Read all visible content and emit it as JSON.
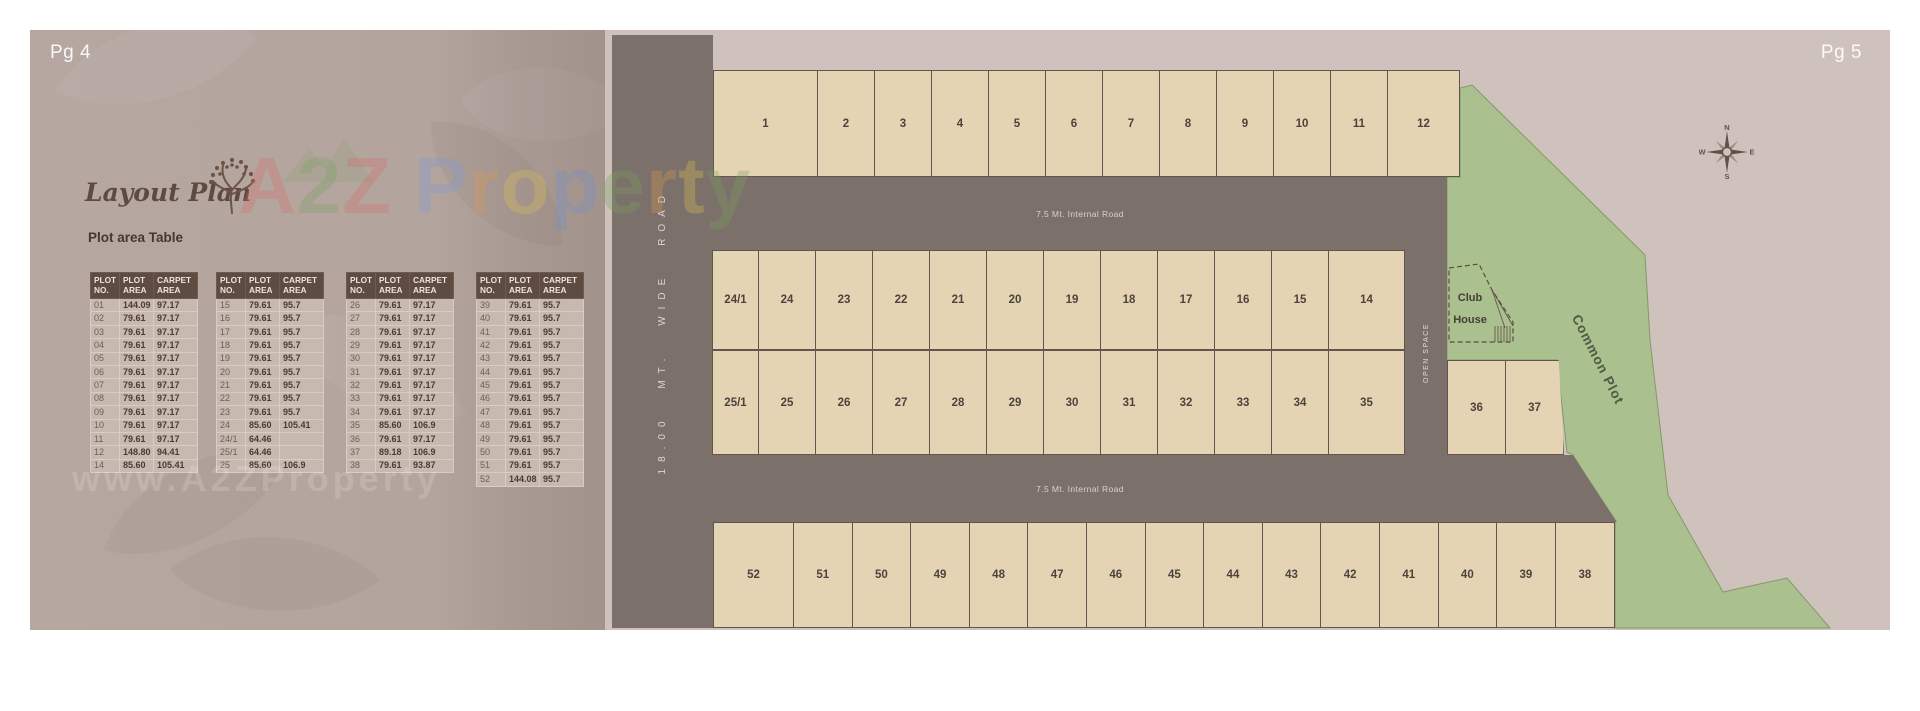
{
  "page_left": {
    "page_label": "Pg 4",
    "title": "Layout Plan",
    "table_title": "Plot area Table",
    "watermark_url": "www.A2ZProperty",
    "watermark_brand": {
      "letters": [
        {
          "ch": "A",
          "color": "#d96a6a"
        },
        {
          "ch": "2",
          "color": "#76a35e"
        },
        {
          "ch": "Z",
          "color": "#d96a6a"
        },
        {
          "ch": " ",
          "color": ""
        },
        {
          "ch": "P",
          "color": "#7b9bd9"
        },
        {
          "ch": "r",
          "color": "#df9a4f"
        },
        {
          "ch": "o",
          "color": "#e3c34f"
        },
        {
          "ch": "p",
          "color": "#6f8fd0"
        },
        {
          "ch": "e",
          "color": "#76a35e"
        },
        {
          "ch": "r",
          "color": "#df9a4f"
        },
        {
          "ch": "t",
          "color": "#e3c34f"
        },
        {
          "ch": "y",
          "color": "#76a35e"
        }
      ]
    },
    "table_headers": [
      "PLOT\nNO.",
      "PLOT\nAREA",
      "CARPET\nAREA"
    ],
    "table_groups": [
      [
        [
          "01",
          "144.09",
          "97.17"
        ],
        [
          "02",
          "79.61",
          "97.17"
        ],
        [
          "03",
          "79.61",
          "97.17"
        ],
        [
          "04",
          "79.61",
          "97.17"
        ],
        [
          "05",
          "79.61",
          "97.17"
        ],
        [
          "06",
          "79.61",
          "97.17"
        ],
        [
          "07",
          "79.61",
          "97.17"
        ],
        [
          "08",
          "79.61",
          "97.17"
        ],
        [
          "09",
          "79.61",
          "97.17"
        ],
        [
          "10",
          "79.61",
          "97.17"
        ],
        [
          "11",
          "79.61",
          "97.17"
        ],
        [
          "12",
          "148.80",
          "94.41"
        ],
        [
          "14",
          "85.60",
          "105.41"
        ]
      ],
      [
        [
          "15",
          "79.61",
          "95.7"
        ],
        [
          "16",
          "79.61",
          "95.7"
        ],
        [
          "17",
          "79.61",
          "95.7"
        ],
        [
          "18",
          "79.61",
          "95.7"
        ],
        [
          "19",
          "79.61",
          "95.7"
        ],
        [
          "20",
          "79.61",
          "95.7"
        ],
        [
          "21",
          "79.61",
          "95.7"
        ],
        [
          "22",
          "79.61",
          "95.7"
        ],
        [
          "23",
          "79.61",
          "95.7"
        ],
        [
          "24",
          "85.60",
          "105.41"
        ],
        [
          "24/1",
          "64.46",
          ""
        ],
        [
          "25/1",
          "64.46",
          ""
        ],
        [
          "25",
          "85.60",
          "106.9"
        ]
      ],
      [
        [
          "26",
          "79.61",
          "97.17"
        ],
        [
          "27",
          "79.61",
          "97.17"
        ],
        [
          "28",
          "79.61",
          "97.17"
        ],
        [
          "29",
          "79.61",
          "97.17"
        ],
        [
          "30",
          "79.61",
          "97.17"
        ],
        [
          "31",
          "79.61",
          "97.17"
        ],
        [
          "32",
          "79.61",
          "97.17"
        ],
        [
          "33",
          "79.61",
          "97.17"
        ],
        [
          "34",
          "79.61",
          "97.17"
        ],
        [
          "35",
          "85.60",
          "106.9"
        ],
        [
          "36",
          "79.61",
          "97.17"
        ],
        [
          "37",
          "89.18",
          "106.9"
        ],
        [
          "38",
          "79.61",
          "93.87"
        ]
      ],
      [
        [
          "39",
          "79.61",
          "95.7"
        ],
        [
          "40",
          "79.61",
          "95.7"
        ],
        [
          "41",
          "79.61",
          "95.7"
        ],
        [
          "42",
          "79.61",
          "95.7"
        ],
        [
          "43",
          "79.61",
          "95.7"
        ],
        [
          "44",
          "79.61",
          "95.7"
        ],
        [
          "45",
          "79.61",
          "95.7"
        ],
        [
          "46",
          "79.61",
          "95.7"
        ],
        [
          "47",
          "79.61",
          "95.7"
        ],
        [
          "48",
          "79.61",
          "95.7"
        ],
        [
          "49",
          "79.61",
          "95.7"
        ],
        [
          "50",
          "79.61",
          "95.7"
        ],
        [
          "51",
          "79.61",
          "95.7"
        ],
        [
          "52",
          "144.08",
          "95.7"
        ]
      ]
    ]
  },
  "page_right": {
    "page_label": "Pg 5",
    "roads": {
      "wide_road": "18.00 MT. WIDE ROAD",
      "internal_top": "7.5 Mt. Internal Road",
      "internal_bottom": "7.5 Mt. Internal Road",
      "open_space": "OPEN SPACE"
    },
    "areas": {
      "club_house_line1": "Club",
      "club_house_line2": "House",
      "common_plot": "Common Plot"
    },
    "plots": {
      "top_row": [
        "1",
        "2",
        "3",
        "4",
        "5",
        "6",
        "7",
        "8",
        "9",
        "10",
        "11",
        "12"
      ],
      "middle_row_upper": [
        "24/1",
        "24",
        "23",
        "22",
        "21",
        "20",
        "19",
        "18",
        "17",
        "16",
        "15",
        "14"
      ],
      "middle_row_lower": [
        "25/1",
        "25",
        "26",
        "27",
        "28",
        "29",
        "30",
        "31",
        "32",
        "33",
        "34",
        "35"
      ],
      "side_pair": [
        "36",
        "37"
      ],
      "bottom_row": [
        "52",
        "51",
        "50",
        "49",
        "48",
        "47",
        "46",
        "45",
        "44",
        "43",
        "42",
        "41",
        "40",
        "39",
        "38"
      ]
    },
    "compass": {
      "north": "N",
      "east": "E",
      "south": "S",
      "west": "W"
    }
  },
  "colors": {
    "page_left_bg": "#b3a49d",
    "page_right_bg": "#cfc1bb",
    "road": "#7c706a",
    "plot_fill": "#e5d4b4",
    "plot_border": "#60564e",
    "green_area": "#aac08f",
    "table_header_bg": "#5e4b42",
    "table_row_bg": "#c7b8b0",
    "dark_text": "#4b433c"
  }
}
